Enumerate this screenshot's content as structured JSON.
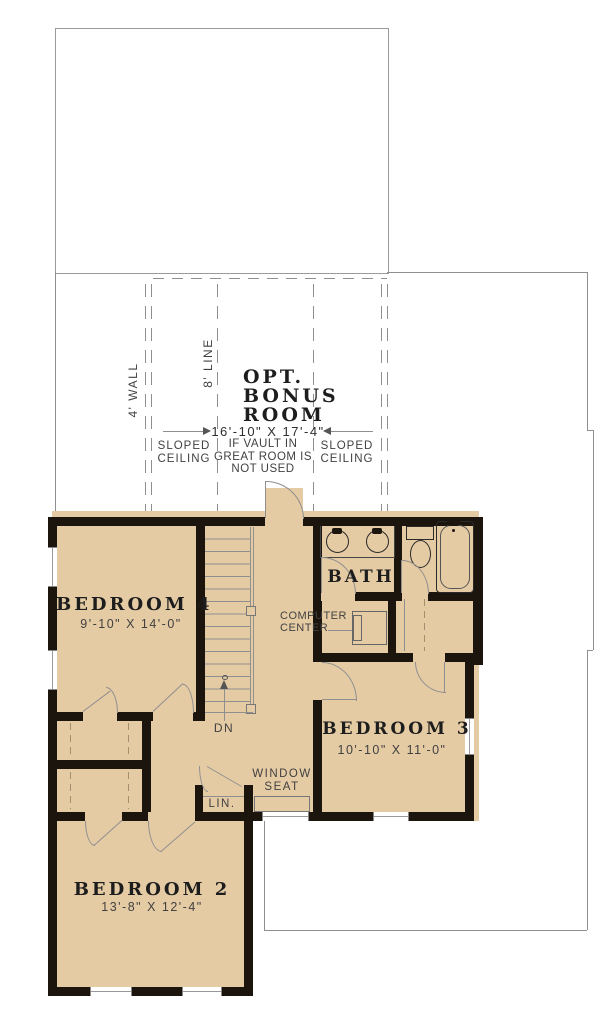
{
  "bonus_room": {
    "title1": "OPT.",
    "title2": "BONUS",
    "title3": "ROOM",
    "dims": "16'-10\" X 17'-4\"",
    "note1": "IF VAULT IN",
    "note2": "GREAT ROOM IS",
    "note3": "NOT USED",
    "sloped_left1": "SLOPED",
    "sloped_left2": "CEILING",
    "sloped_right1": "SLOPED",
    "sloped_right2": "CEILING",
    "wall_label": "4' WALL",
    "line_label": "8' LINE"
  },
  "rooms": {
    "bedroom4": {
      "name": "BEDROOM 4",
      "dims": "9'-10\" X 14'-0\""
    },
    "bedroom3": {
      "name": "BEDROOM 3",
      "dims": "10'-10\" X 11'-0\""
    },
    "bedroom2": {
      "name": "BEDROOM 2",
      "dims": "13'-8\" X 12'-4\""
    },
    "bath": {
      "name": "BATH"
    }
  },
  "labels": {
    "dn": "DN",
    "lin": "LIN.",
    "window_seat1": "WINDOW",
    "window_seat2": "SEAT",
    "computer1": "COMPUTER",
    "computer2": "CENTER"
  },
  "colors": {
    "floor": "#e5cba4",
    "wall": "#1c150e",
    "thin_line": "#8f8f8f"
  }
}
